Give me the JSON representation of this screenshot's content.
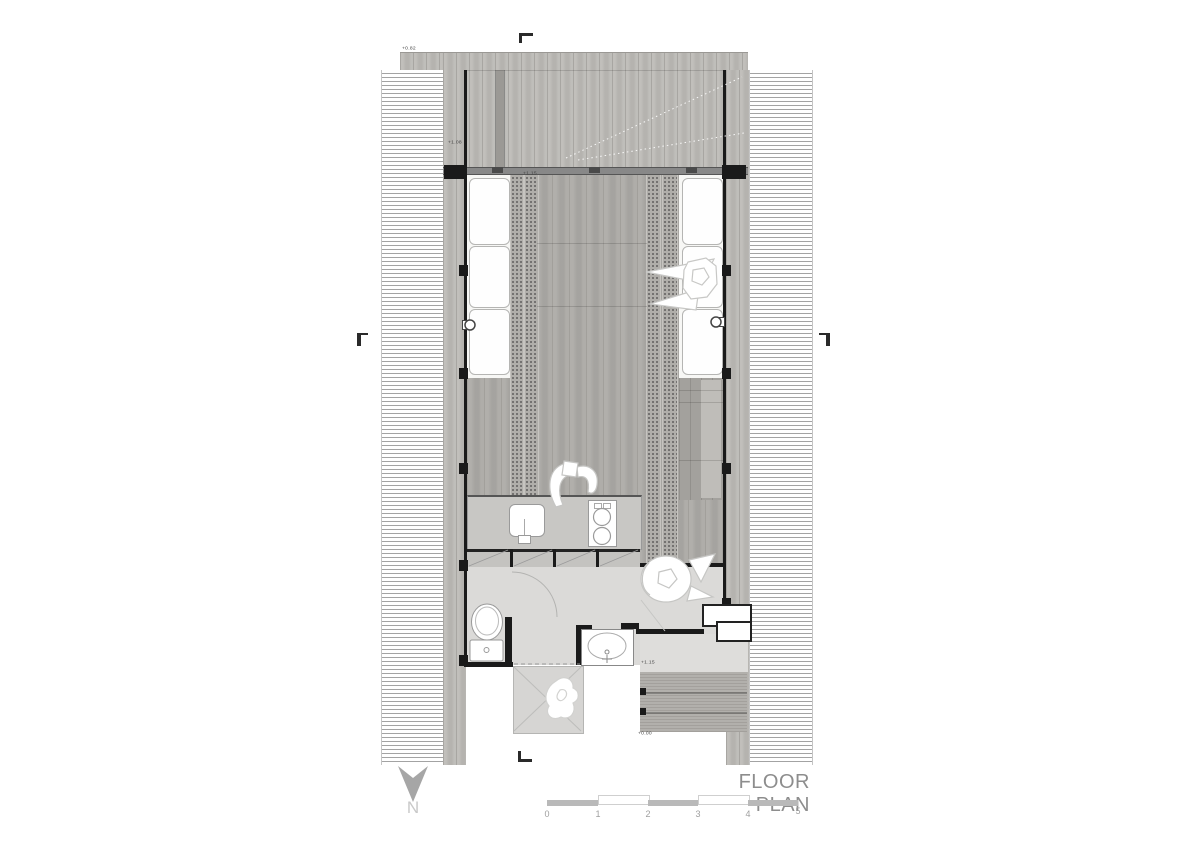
{
  "title": "FLOOR PLAN",
  "north": {
    "label": "N"
  },
  "icons": {
    "north_arrow": "▼"
  },
  "scale_bar": {
    "ticks": [
      "0",
      "1",
      "2",
      "3",
      "4",
      "5"
    ]
  },
  "levels": [
    {
      "id": "deck-top-edge",
      "text": "+0.82"
    },
    {
      "id": "deck-inner",
      "text": "+1.08"
    },
    {
      "id": "main-hall",
      "text": "+1.15"
    },
    {
      "id": "bath-threshold",
      "text": "+1.15"
    },
    {
      "id": "entry-grade",
      "text": "+0.00"
    }
  ],
  "colors": {
    "paper": "#ffffff",
    "deck_wood": "#bcbab6",
    "interior_wood": "#acaaa6",
    "slat_floor": "#b0aeaa",
    "bath_floor": "#dbdad8",
    "wall_black": "#1a1a1a",
    "annotation_gray": "#8d8d8d"
  }
}
